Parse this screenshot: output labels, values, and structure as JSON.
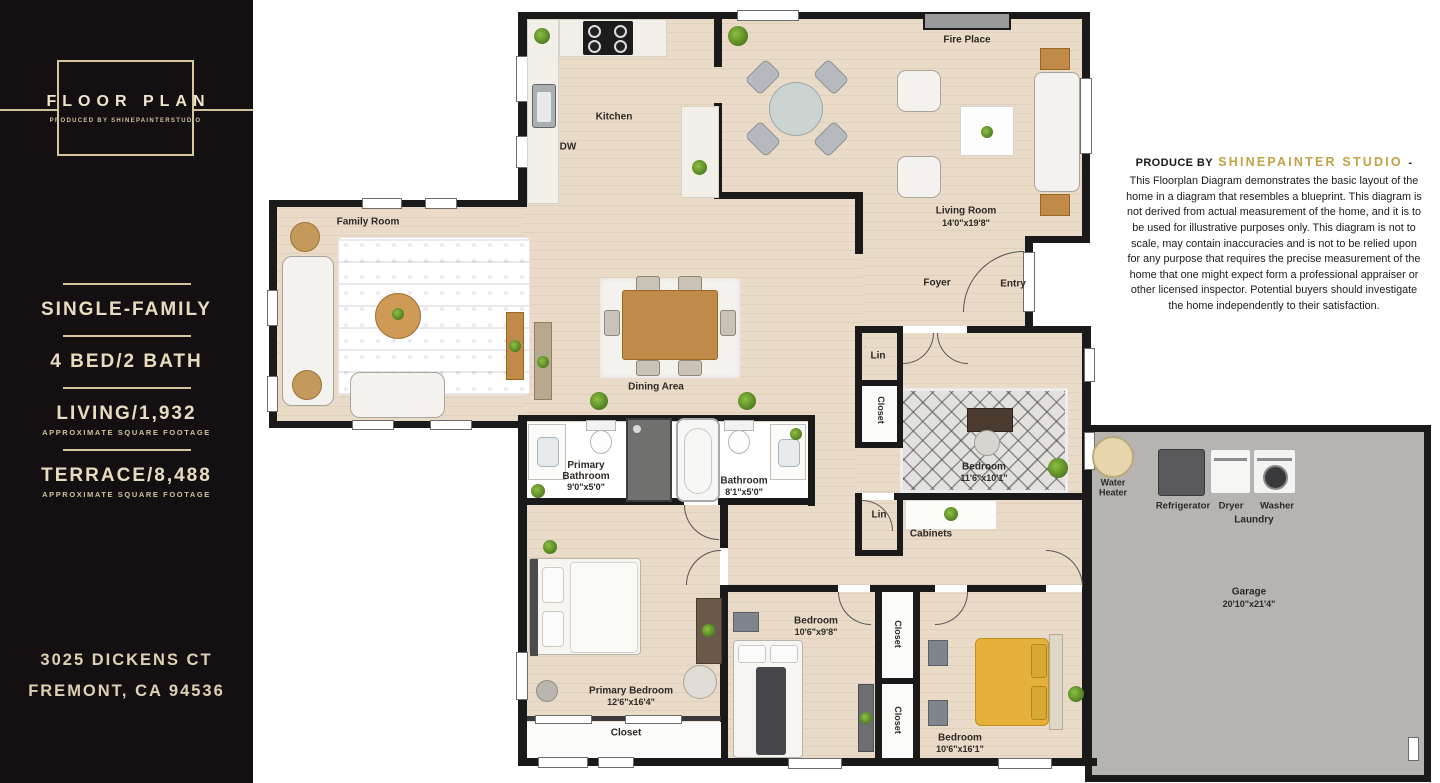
{
  "colors": {
    "accent_gold": "#c3a145",
    "sidebar_bg": "#141011",
    "sidebar_text": "#e2d6ba",
    "wall": "#1a1a1a",
    "floor": "#e9dbc8",
    "garage_floor": "#b5b4b1"
  },
  "sidebar": {
    "logo_title": "FLOOR PLAN",
    "logo_subtitle": "PRODUCED BY SHINEPAINTERSTUDIO",
    "stats": [
      {
        "label": "SINGLE-FAMILY",
        "sub": ""
      },
      {
        "label": "4 BED/2 BATH",
        "sub": ""
      },
      {
        "label": "LIVING/1,932",
        "sub": "APPROXIMATE SQUARE FOOTAGE"
      },
      {
        "label": "TERRACE/8,488",
        "sub": "APPROXIMATE SQUARE FOOTAGE"
      }
    ],
    "address_line1": "3025 DICKENS CT",
    "address_line2": "FREMONT, CA 94536"
  },
  "disclaimer": {
    "prefix": "PRODUCE BY",
    "studio": "SHINEPAINTER STUDIO",
    "dash": "-",
    "body": "This Floorplan Diagram demonstrates the basic layout of the home in a diagram that resembles a blueprint. This diagram is not derived from actual measurement of the home, and it is to be used for illustrative purposes only. This diagram is not to scale, may contain inaccuracies and is not to be relied upon for any purpose that requires the precise measurement of the home that one might expect form a professional appraiser or other licensed inspector. Potential buyers should investigate the home independently to their satisfaction."
  },
  "plan": {
    "kitchen": "Kitchen",
    "dw": "DW",
    "family_room": "Family Room",
    "living_room": "Living Room",
    "living_room_dims": "14'0\"x19'8\"",
    "fire_place": "Fire Place",
    "dining_area": "Dining Area",
    "foyer": "Foyer",
    "entry": "Entry",
    "lin_upper": "Lin",
    "closet_upper": "Closet",
    "bedroom1": "Bedroom",
    "bedroom1_dims": "11'6\"x10'1\"",
    "primary_bathroom_line1": "Primary",
    "primary_bathroom_line2": "Bathroom",
    "primary_bathroom_dims": "9'0\"x5'0\"",
    "bathroom": "Bathroom",
    "bathroom_dims": "8'1\"x5'0\"",
    "lin_hall": "Lin",
    "cabinets": "Cabinets",
    "water_heater": "Water Heater",
    "refrigerator": "Refrigerator",
    "dryer": "Dryer",
    "washer": "Washer",
    "laundry": "Laundry",
    "garage": "Garage",
    "garage_dims": "20'10\"x21'4\"",
    "primary_bedroom": "Primary Bedroom",
    "primary_bedroom_dims": "12'6\"x16'4\"",
    "closet_primary": "Closet",
    "bedroom2": "Bedroom",
    "bedroom2_dims": "10'6\"x9'8\"",
    "closet_mid_upper": "Closet",
    "closet_mid_lower": "Closet",
    "bedroom3": "Bedroom",
    "bedroom3_dims": "10'6\"x16'1\""
  }
}
